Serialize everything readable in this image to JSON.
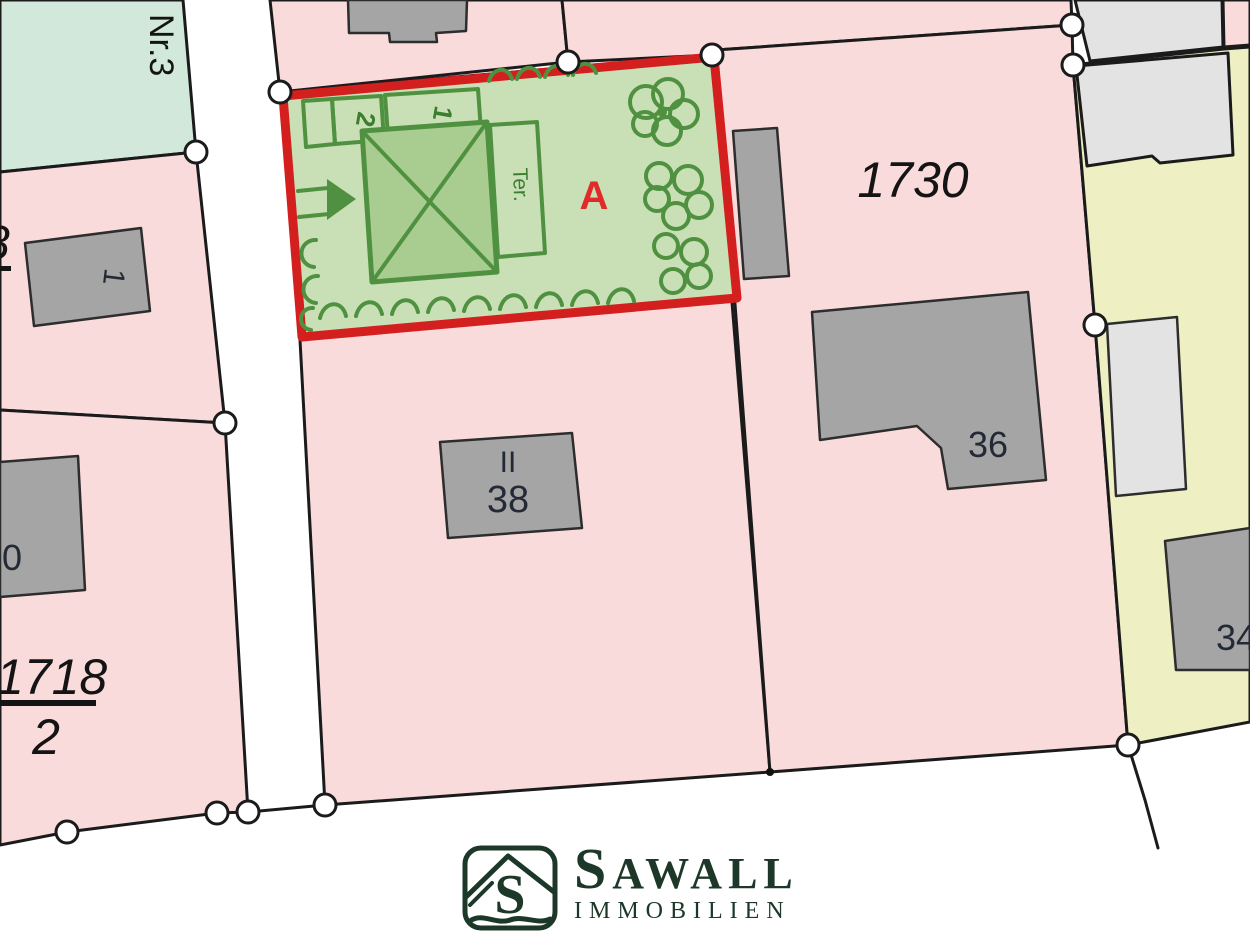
{
  "colors": {
    "pink": "#f9dbdc",
    "mint": "#d2e8da",
    "yellow": "#eef0c3",
    "building_gray": "#a5a5a5",
    "building_light": "#e3e3e3",
    "sketch_bg": "#c9e0b6",
    "sketch_green": "#4f9140",
    "red_boundary": "#d41f1f",
    "area_label_red": "#e12b2b",
    "logo_green": "#1d3829"
  },
  "labels": {
    "nr3": "Nr.3",
    "parcel_1730": "1730",
    "parcel_1718_num": "1718",
    "parcel_1718_den": "2",
    "partial_left": "8",
    "building_one": "1",
    "building_zero": "0",
    "storeys": "II",
    "house_38": "38",
    "house_36": "36",
    "house_34": "34",
    "area": "A",
    "sketch_cell_2": "2",
    "sketch_cell_1": "1",
    "sketch_terrace": "Ter."
  },
  "logo": {
    "monogram": "S",
    "name_initial": "S",
    "name_rest": "AWALL",
    "subtitle": "IMMOBILIEN"
  }
}
